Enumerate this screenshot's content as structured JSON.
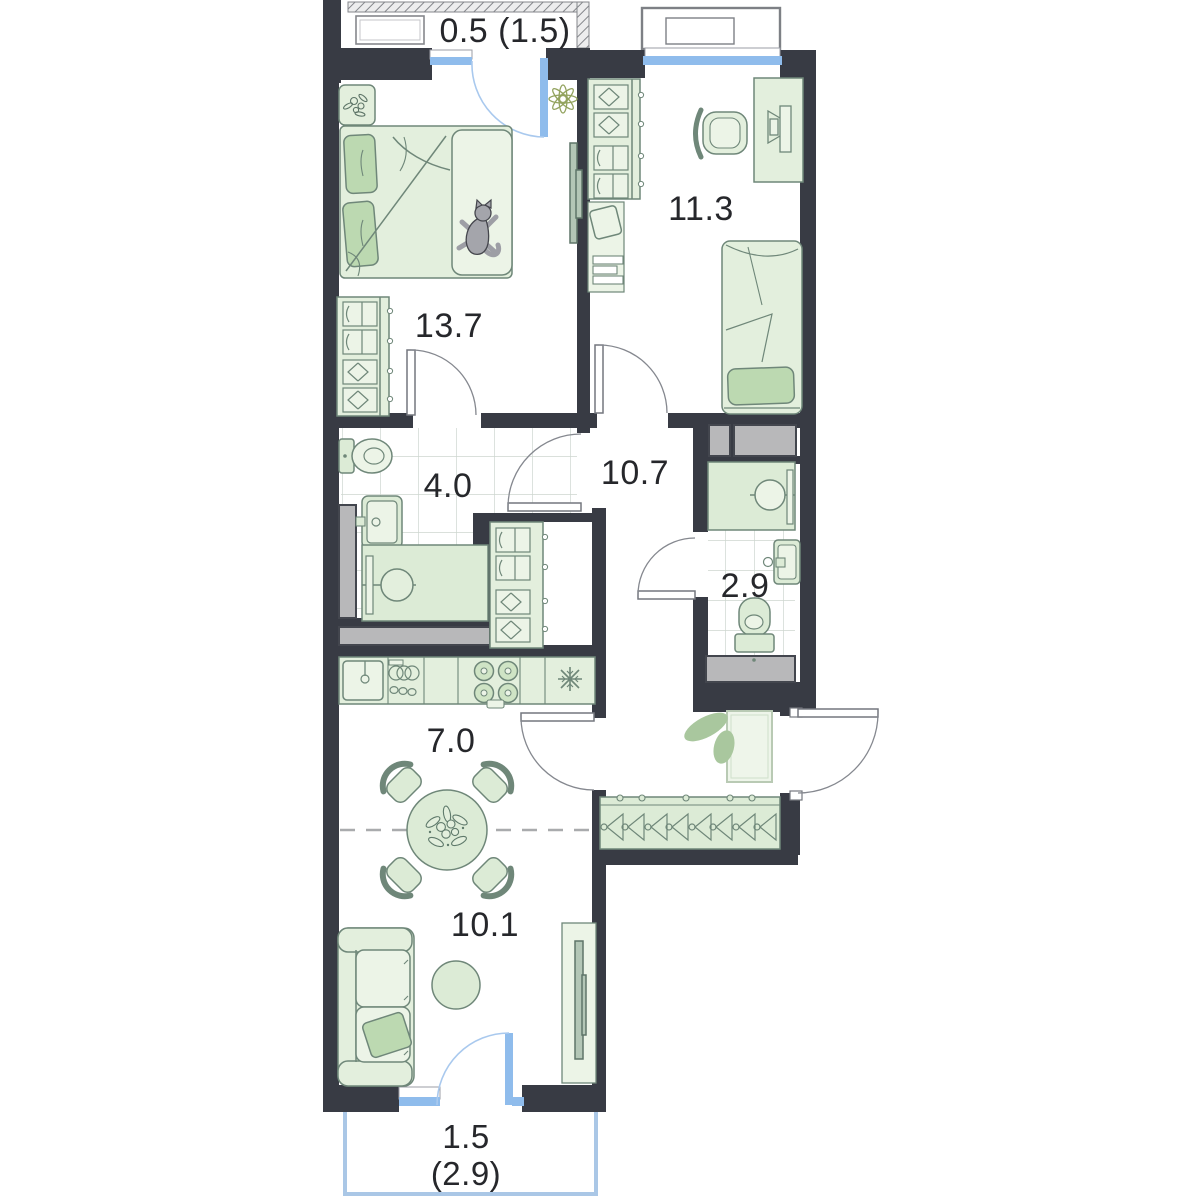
{
  "plan": {
    "type": "apartment-floor-plan",
    "labels": {
      "balcony_top": "0.5 (1.5)",
      "room_11_3": "11.3",
      "bedroom_13_7": "13.7",
      "bathroom_4_0": "4.0",
      "hallway_10_7": "10.7",
      "wc_2_9": "2.9",
      "kitchen_7_0": "7.0",
      "living_10_1": "10.1",
      "balcony_bottom_line1": "1.5",
      "balcony_bottom_line2": "(2.9)"
    },
    "colors": {
      "wall": "#383b44",
      "furniture_fill": "#e3efdd",
      "furniture_fill_light": "#ecf4e7",
      "pillow_green": "#bcd9b1",
      "furniture_stroke": "#6f8779",
      "window_blue": "#8fbcec",
      "shaft_grey": "#b8b8ba",
      "tile_line": "#cdd6cf",
      "dashed_line": "#a9abad",
      "plant_olive": "#93a35f",
      "text": "#26272b"
    }
  }
}
